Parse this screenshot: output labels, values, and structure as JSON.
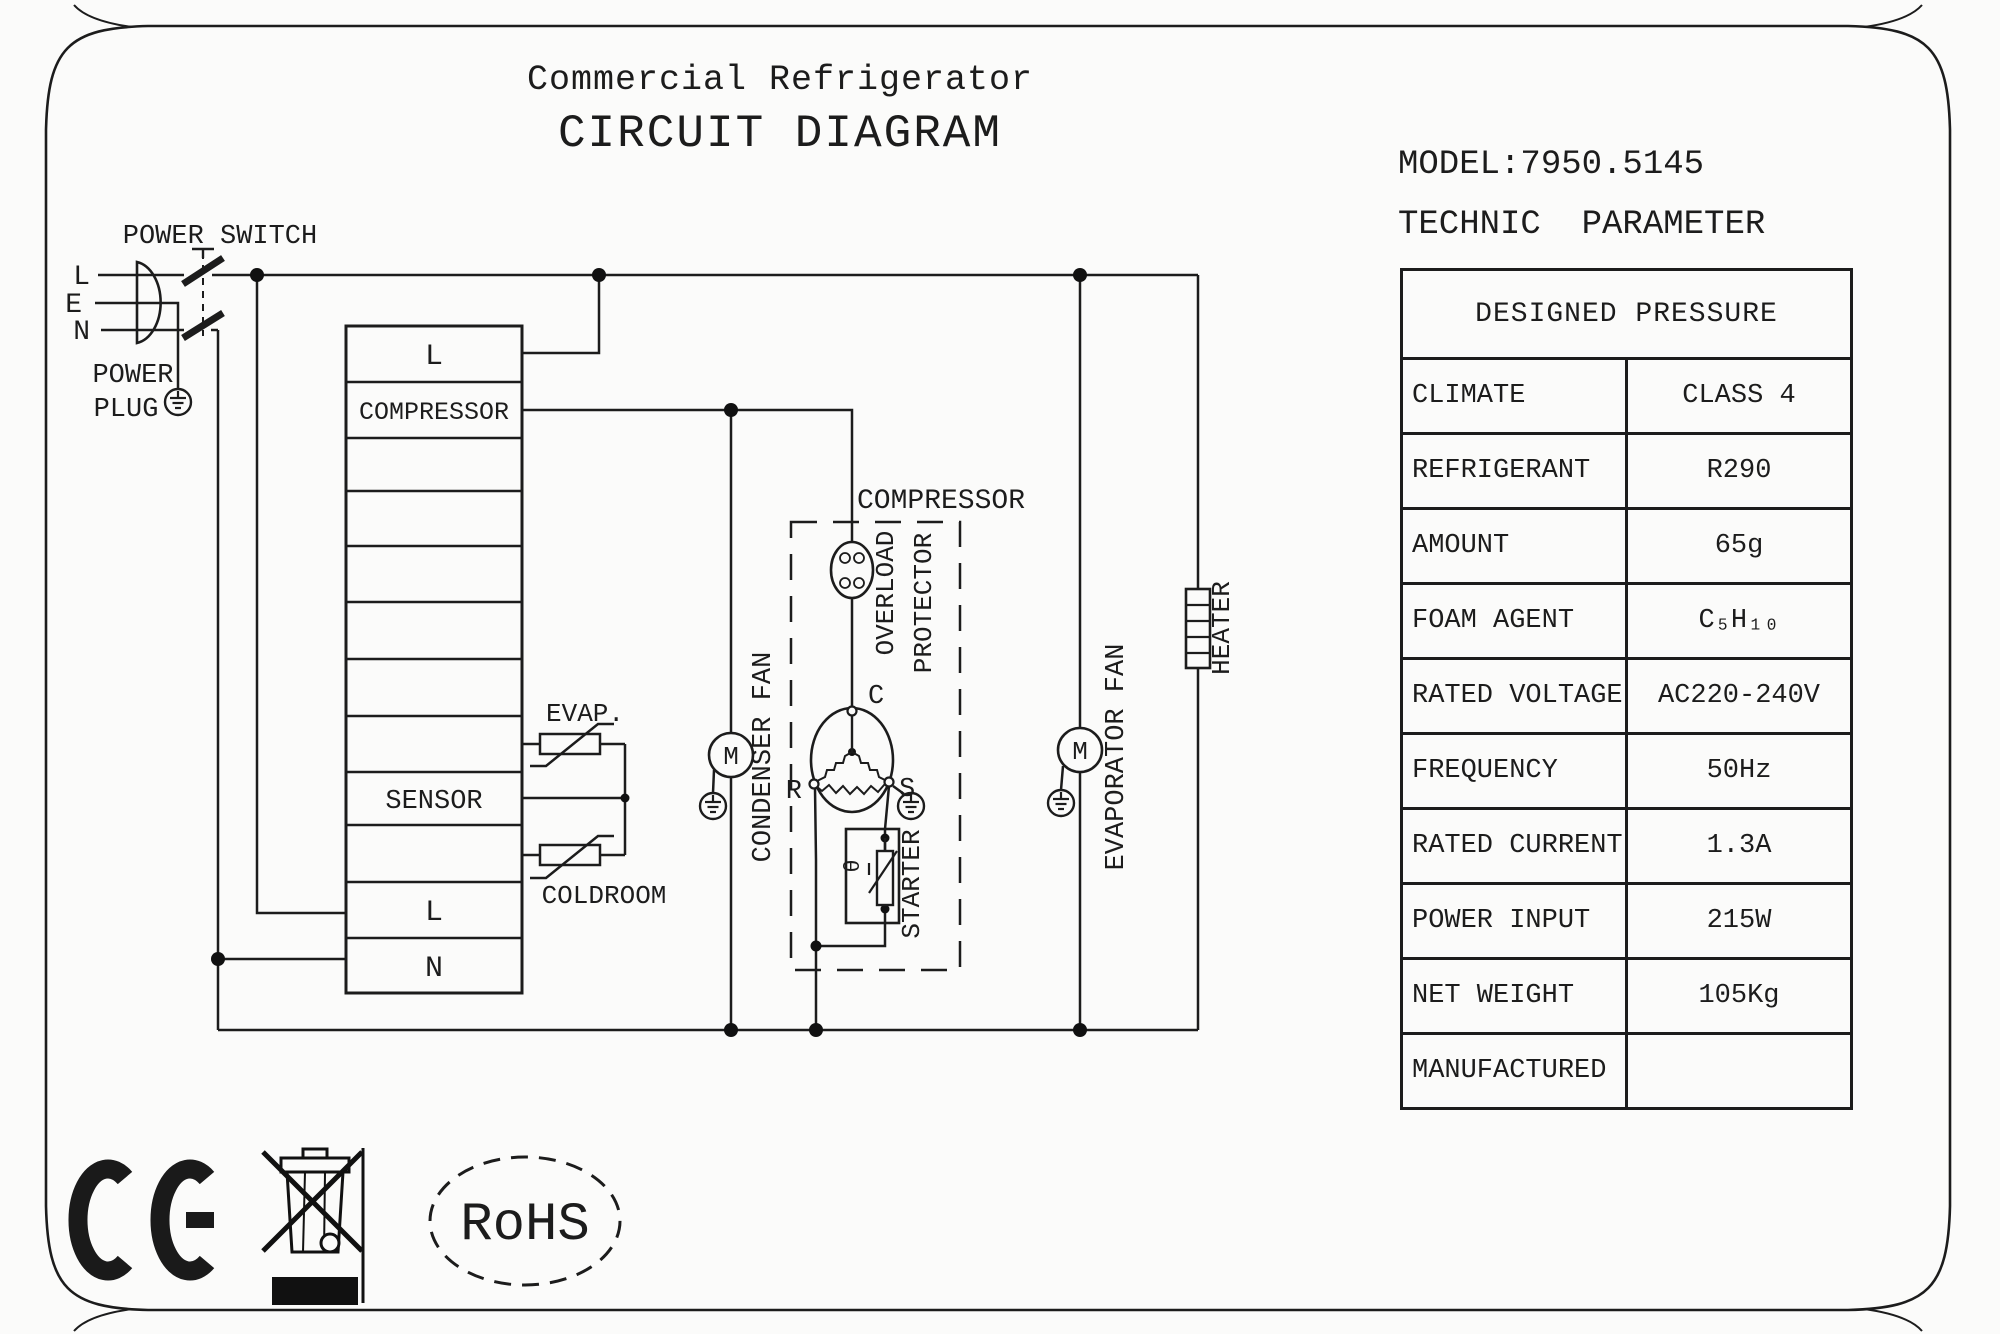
{
  "title": {
    "line1": "Commercial Refrigerator",
    "line2": "CIRCUIT DIAGRAM"
  },
  "spec": {
    "model": "MODEL:7950.5145",
    "heading": "TECHNIC  PARAMETER",
    "table": {
      "header": "DESIGNED PRESSURE",
      "rows": [
        {
          "label": "CLIMATE",
          "value": "CLASS 4"
        },
        {
          "label": "REFRIGERANT",
          "value": "R290"
        },
        {
          "label": "AMOUNT",
          "value": "65g"
        },
        {
          "label": "FOAM AGENT",
          "value": "C₅H₁₀"
        },
        {
          "label": "RATED VOLTAGE",
          "value": "AC220-240V"
        },
        {
          "label": "FREQUENCY",
          "value": "50Hz"
        },
        {
          "label": "RATED CURRENT",
          "value": "1.3A"
        },
        {
          "label": "POWER INPUT",
          "value": "215W"
        },
        {
          "label": "NET WEIGHT",
          "value": "105Kg"
        },
        {
          "label": "MANUFACTURED",
          "value": ""
        }
      ]
    }
  },
  "diagram": {
    "power_switch": "POWER SWITCH",
    "power_plug_line1": "POWER",
    "power_plug_line2": "PLUG",
    "pin_l": "L",
    "pin_e": "E",
    "pin_n": "N",
    "terminal_block": {
      "row1": "L",
      "row2": "COMPRESSOR",
      "row9": "SENSOR",
      "row11": "L",
      "row12": "N"
    },
    "evap_sensor": "EVAP.",
    "coldroom_sensor": "COLDROOM",
    "condenser_fan": "CONDENSER FAN",
    "compressor": "COMPRESSOR",
    "overload_line1": "OVERLOAD",
    "overload_line2": "PROTECTOR",
    "motor_letter": "M",
    "motor_terminal_c": "C",
    "motor_terminal_r": "R",
    "motor_terminal_s": "S",
    "starter": "STARTER",
    "starter_theta": "θ",
    "evaporator_fan": "EVAPORATOR FAN",
    "heater": "HEATER"
  },
  "certifications": {
    "ce": "CE",
    "weee": "crossed-out-wheelie-bin",
    "rohs": "RoHS"
  },
  "colors": {
    "line": "#1c1c1c",
    "background": "#fbfbfa"
  }
}
